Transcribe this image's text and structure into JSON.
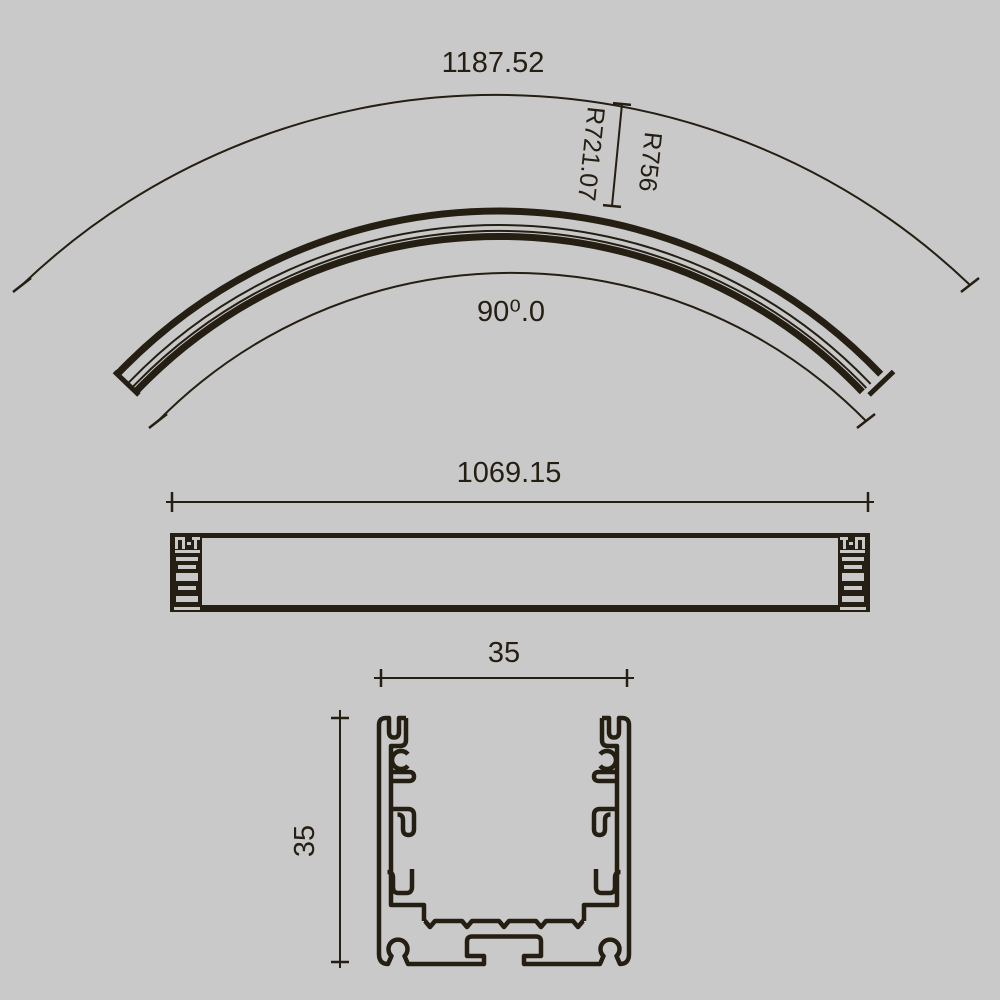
{
  "canvas": {
    "background_color": "#c9c9c9",
    "line_color": "#251e13"
  },
  "curved_view": {
    "arc_length_label": "1187.52",
    "outer_radius_label": "R756",
    "inner_radius_label": "R721.07",
    "angle_label": "90⁰.0"
  },
  "side_view": {
    "length_label": "1069.15"
  },
  "cross_section": {
    "width_label": "35",
    "height_label": "35"
  }
}
